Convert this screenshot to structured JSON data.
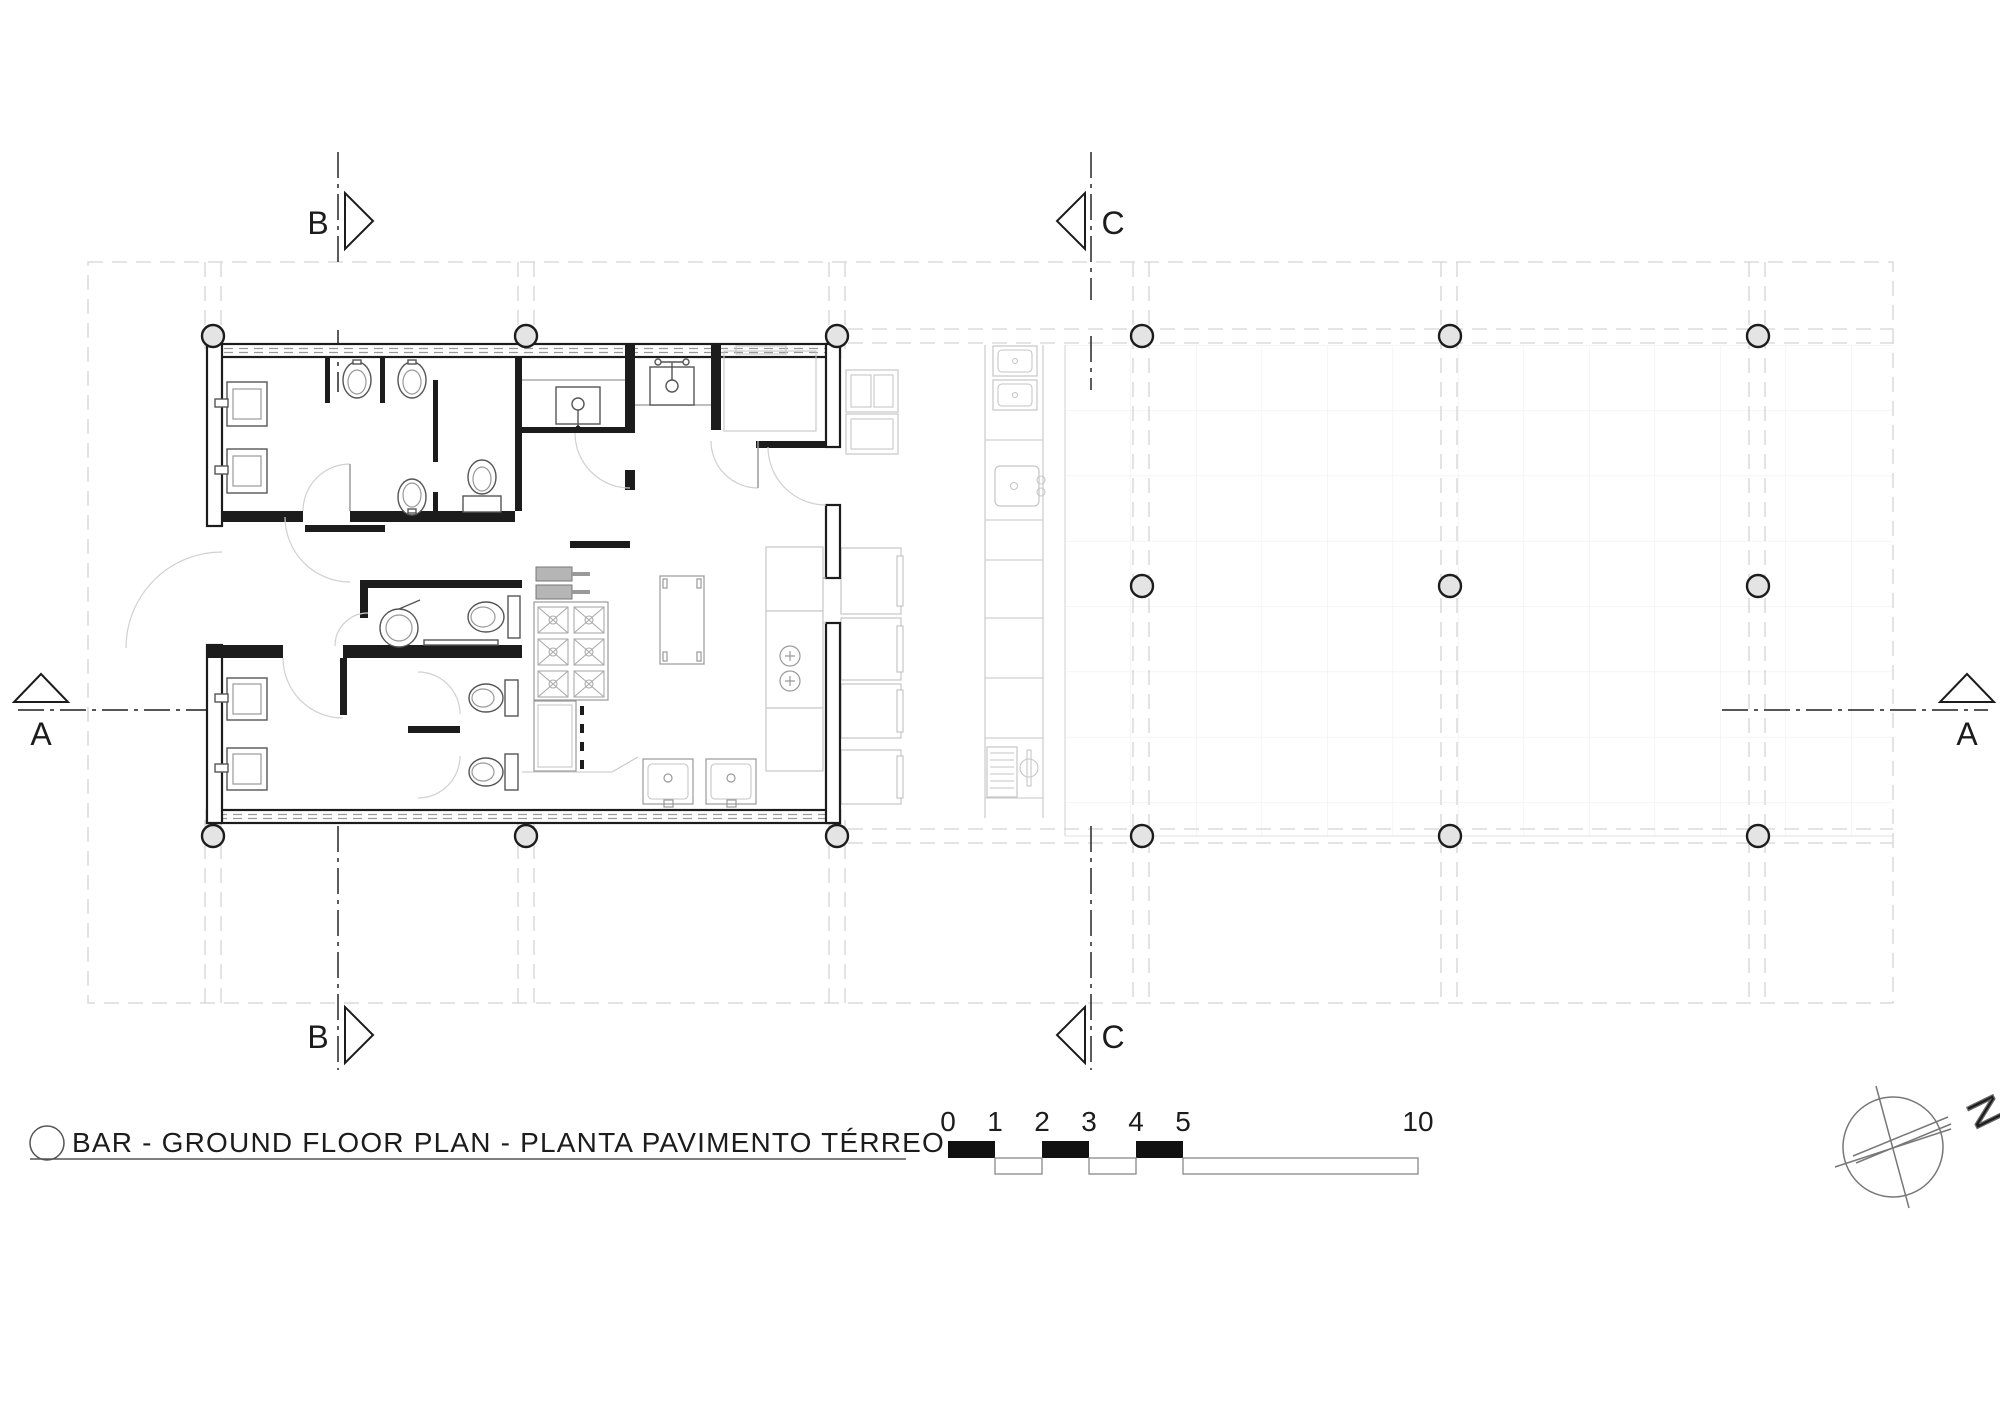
{
  "page": {
    "width": 2000,
    "height": 1415,
    "background": "#ffffff"
  },
  "title_block": {
    "label": "BAR - GROUND FLOOR PLAN - PLANTA PAVIMENTO TÉRREO"
  },
  "section_markers": {
    "a": "A",
    "b": "B",
    "c": "C"
  },
  "north_arrow": {
    "label": "N"
  },
  "scale_bar": {
    "ticks": [
      "0",
      "1",
      "2",
      "3",
      "4",
      "5",
      "10"
    ]
  },
  "colors": {
    "wall": "#1c1c1c",
    "fixture_line": "#555555",
    "faded_line": "#c6c6c6",
    "axis_dash": "#d4d4d4",
    "tile_grid": "#efefef",
    "scale_black": "#111111"
  },
  "plan_features": [
    "mens-wc",
    "accessible-wc",
    "womens-wc",
    "kitchen",
    "storage",
    "bar-counter",
    "outdoor-deck",
    "structural-columns"
  ]
}
